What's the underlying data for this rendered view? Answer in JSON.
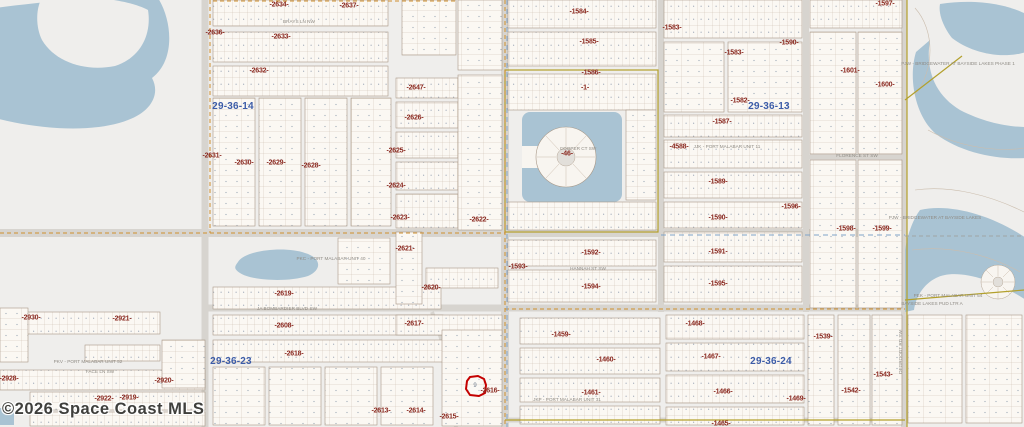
{
  "map": {
    "copyright": "©2026 Space Coast MLS",
    "highlighted_parcel": {
      "lot_number": "9",
      "plat_label": "-2616-"
    }
  },
  "colors": {
    "land": "#efeeec",
    "parcel_fill": "#fbf8f3",
    "water": "#a9c3d3",
    "highlight_red": "#c40000",
    "plat_label": "#8b2a21",
    "section_label": "#3c5ca8",
    "boundary_olive": "#b3a02c",
    "boundary_orange": "#cf8f2e",
    "canal_blue": "#7fa3c8"
  },
  "section_labels": [
    {
      "text": "29-36-14",
      "x": 233,
      "y": 107
    },
    {
      "text": "29-36-13",
      "x": 769,
      "y": 107
    },
    {
      "text": "29-36-23",
      "x": 231,
      "y": 362
    },
    {
      "text": "29-36-24",
      "x": 771,
      "y": 362
    }
  ],
  "plat_labels": [
    {
      "text": "-2636-",
      "x": 215,
      "y": 33
    },
    {
      "text": "-2634-",
      "x": 279,
      "y": 5
    },
    {
      "text": "-2637-",
      "x": 349,
      "y": 6
    },
    {
      "text": "-2633-",
      "x": 281,
      "y": 37
    },
    {
      "text": "-2632-",
      "x": 259,
      "y": 71
    },
    {
      "text": "-2647-",
      "x": 416,
      "y": 88
    },
    {
      "text": "-2626-",
      "x": 414,
      "y": 118
    },
    {
      "text": "-2631-",
      "x": 212,
      "y": 156
    },
    {
      "text": "-2630-",
      "x": 244,
      "y": 163
    },
    {
      "text": "-2629-",
      "x": 276,
      "y": 163
    },
    {
      "text": "-2628-",
      "x": 311,
      "y": 166
    },
    {
      "text": "-2625-",
      "x": 396,
      "y": 151
    },
    {
      "text": "-2624-",
      "x": 396,
      "y": 186
    },
    {
      "text": "-2623-",
      "x": 400,
      "y": 218
    },
    {
      "text": "-2622-",
      "x": 479,
      "y": 220
    },
    {
      "text": "-2621-",
      "x": 405,
      "y": 249
    },
    {
      "text": "-2620-",
      "x": 431,
      "y": 288
    },
    {
      "text": "-2619-",
      "x": 284,
      "y": 294
    },
    {
      "text": "-2618-",
      "x": 294,
      "y": 354
    },
    {
      "text": "-2617-",
      "x": 414,
      "y": 324
    },
    {
      "text": "-2616-",
      "x": 490,
      "y": 391
    },
    {
      "text": "-2615-",
      "x": 449,
      "y": 417
    },
    {
      "text": "-2614-",
      "x": 416,
      "y": 411
    },
    {
      "text": "-2613-",
      "x": 381,
      "y": 411
    },
    {
      "text": "-2608-",
      "x": 284,
      "y": 326
    },
    {
      "text": "-2930-",
      "x": 31,
      "y": 318
    },
    {
      "text": "-2921-",
      "x": 122,
      "y": 319
    },
    {
      "text": "-2928-",
      "x": 9,
      "y": 379
    },
    {
      "text": "-2920-",
      "x": 164,
      "y": 381
    },
    {
      "text": "-2922-",
      "x": 104,
      "y": 399
    },
    {
      "text": "-2919-",
      "x": 129,
      "y": 398
    },
    {
      "text": "-1584-",
      "x": 579,
      "y": 12
    },
    {
      "text": "-1585-",
      "x": 589,
      "y": 42
    },
    {
      "text": "-1586-",
      "x": 591,
      "y": 73
    },
    {
      "text": "-1-",
      "x": 585,
      "y": 88
    },
    {
      "text": "-46-",
      "x": 567,
      "y": 154
    },
    {
      "text": "-1583-",
      "x": 672,
      "y": 28
    },
    {
      "text": "-1583-",
      "x": 734,
      "y": 53
    },
    {
      "text": "-1590-",
      "x": 789,
      "y": 43
    },
    {
      "text": "-1582-",
      "x": 740,
      "y": 101
    },
    {
      "text": "-1587-",
      "x": 722,
      "y": 122
    },
    {
      "text": "-4588-",
      "x": 679,
      "y": 147
    },
    {
      "text": "-1589-",
      "x": 718,
      "y": 182
    },
    {
      "text": "-1590-",
      "x": 718,
      "y": 218
    },
    {
      "text": "-1596-",
      "x": 791,
      "y": 207
    },
    {
      "text": "-1591-",
      "x": 718,
      "y": 252
    },
    {
      "text": "-1595-",
      "x": 718,
      "y": 284
    },
    {
      "text": "-1592-",
      "x": 591,
      "y": 253
    },
    {
      "text": "-1593-",
      "x": 518,
      "y": 267
    },
    {
      "text": "-1594-",
      "x": 591,
      "y": 287
    },
    {
      "text": "-1598-",
      "x": 846,
      "y": 229
    },
    {
      "text": "-1599-",
      "x": 882,
      "y": 229
    },
    {
      "text": "-1597-",
      "x": 885,
      "y": 4
    },
    {
      "text": "-1601-",
      "x": 850,
      "y": 71
    },
    {
      "text": "-1600-",
      "x": 885,
      "y": 85
    },
    {
      "text": "-1459-",
      "x": 561,
      "y": 335
    },
    {
      "text": "-1460-",
      "x": 606,
      "y": 360
    },
    {
      "text": "-1461-",
      "x": 591,
      "y": 393
    },
    {
      "text": "-1468-",
      "x": 695,
      "y": 324
    },
    {
      "text": "-1467-",
      "x": 711,
      "y": 357
    },
    {
      "text": "-1466-",
      "x": 723,
      "y": 392
    },
    {
      "text": "-1465-",
      "x": 721,
      "y": 424
    },
    {
      "text": "-1469-",
      "x": 796,
      "y": 399
    },
    {
      "text": "-1539-",
      "x": 823,
      "y": 337
    },
    {
      "text": "-1542-",
      "x": 851,
      "y": 391
    },
    {
      "text": "-1543-",
      "x": 883,
      "y": 375
    }
  ],
  "street_labels": [
    {
      "text": "BRAYS LN NW",
      "x": 299,
      "y": 22
    },
    {
      "text": "FLORENCE ST SW",
      "x": 857,
      "y": 156
    },
    {
      "text": "COOPER CT SW",
      "x": 578,
      "y": 149
    },
    {
      "text": "JJK - PORT MALABAR UNIT 11",
      "x": 727,
      "y": 147
    },
    {
      "text": "PJW - BRIDGEWATER AT BAYSIDE LAKES PHASE 1",
      "x": 958,
      "y": 64
    },
    {
      "text": "PJW - BRIDGEWATER AT BAYSIDE LAKES",
      "x": 935,
      "y": 218
    },
    {
      "text": "PEK - PORT MALABAR UNIT 54",
      "x": 948,
      "y": 296
    },
    {
      "text": "BAYSIDE LAKES PUD LTR A",
      "x": 932,
      "y": 304
    },
    {
      "text": "PKC - PORT MALABAR UNIT 40",
      "x": 331,
      "y": 259
    },
    {
      "text": "PKV - PORT MALABAR UNIT 52",
      "x": 88,
      "y": 362
    },
    {
      "text": "JKP - PORT MALABAR UNIT 31",
      "x": 567,
      "y": 400
    },
    {
      "text": "JA BOMBARDIER BLVD SW",
      "x": 287,
      "y": 309
    },
    {
      "text": "FACE LN SW",
      "x": 100,
      "y": 372
    },
    {
      "text": "HANNAH ST SW",
      "x": 588,
      "y": 269
    },
    {
      "text": "DEGROODT RD SW",
      "x": 901,
      "y": 352,
      "rot": true
    }
  ]
}
